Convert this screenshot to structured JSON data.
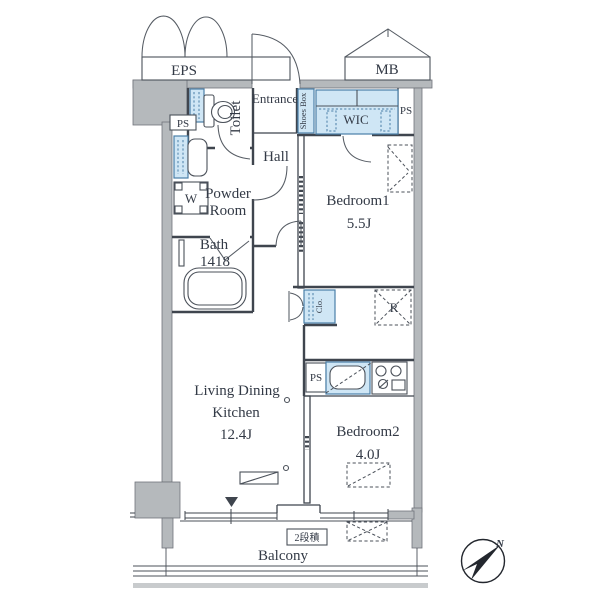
{
  "labels": {
    "eps": "EPS",
    "mb": "MB",
    "toilet": "Toilet",
    "entrance": "Entrance",
    "shoes_box": "Shoes Box",
    "wic": "WIC",
    "ps_top_right": "PS",
    "ps_left": "PS",
    "hall": "Hall",
    "powder_room_line1": "Powder",
    "powder_room_line2": "Room",
    "bath_line1": "Bath",
    "bath_line2": "1418",
    "washer": "W",
    "bedroom1_name": "Bedroom1",
    "bedroom1_size": "5.5J",
    "closet": "Clo.",
    "refrigerator": "R",
    "ps_kitchen": "PS",
    "ldk_line1": "Living Dining",
    "ldk_line2": "Kitchen",
    "ldk_size": "12.4J",
    "bedroom2_name": "Bedroom2",
    "bedroom2_size": "4.0J",
    "balcony": "Balcony",
    "stack_note": "2段積",
    "compass_north": "N"
  },
  "colors": {
    "fixture_blue": "#cfe6f5",
    "fixture_blue_border": "#4a7fa8",
    "wall_gray": "#b5b9bc",
    "line": "#3f454e",
    "text": "#333a46",
    "background": "#ffffff"
  }
}
